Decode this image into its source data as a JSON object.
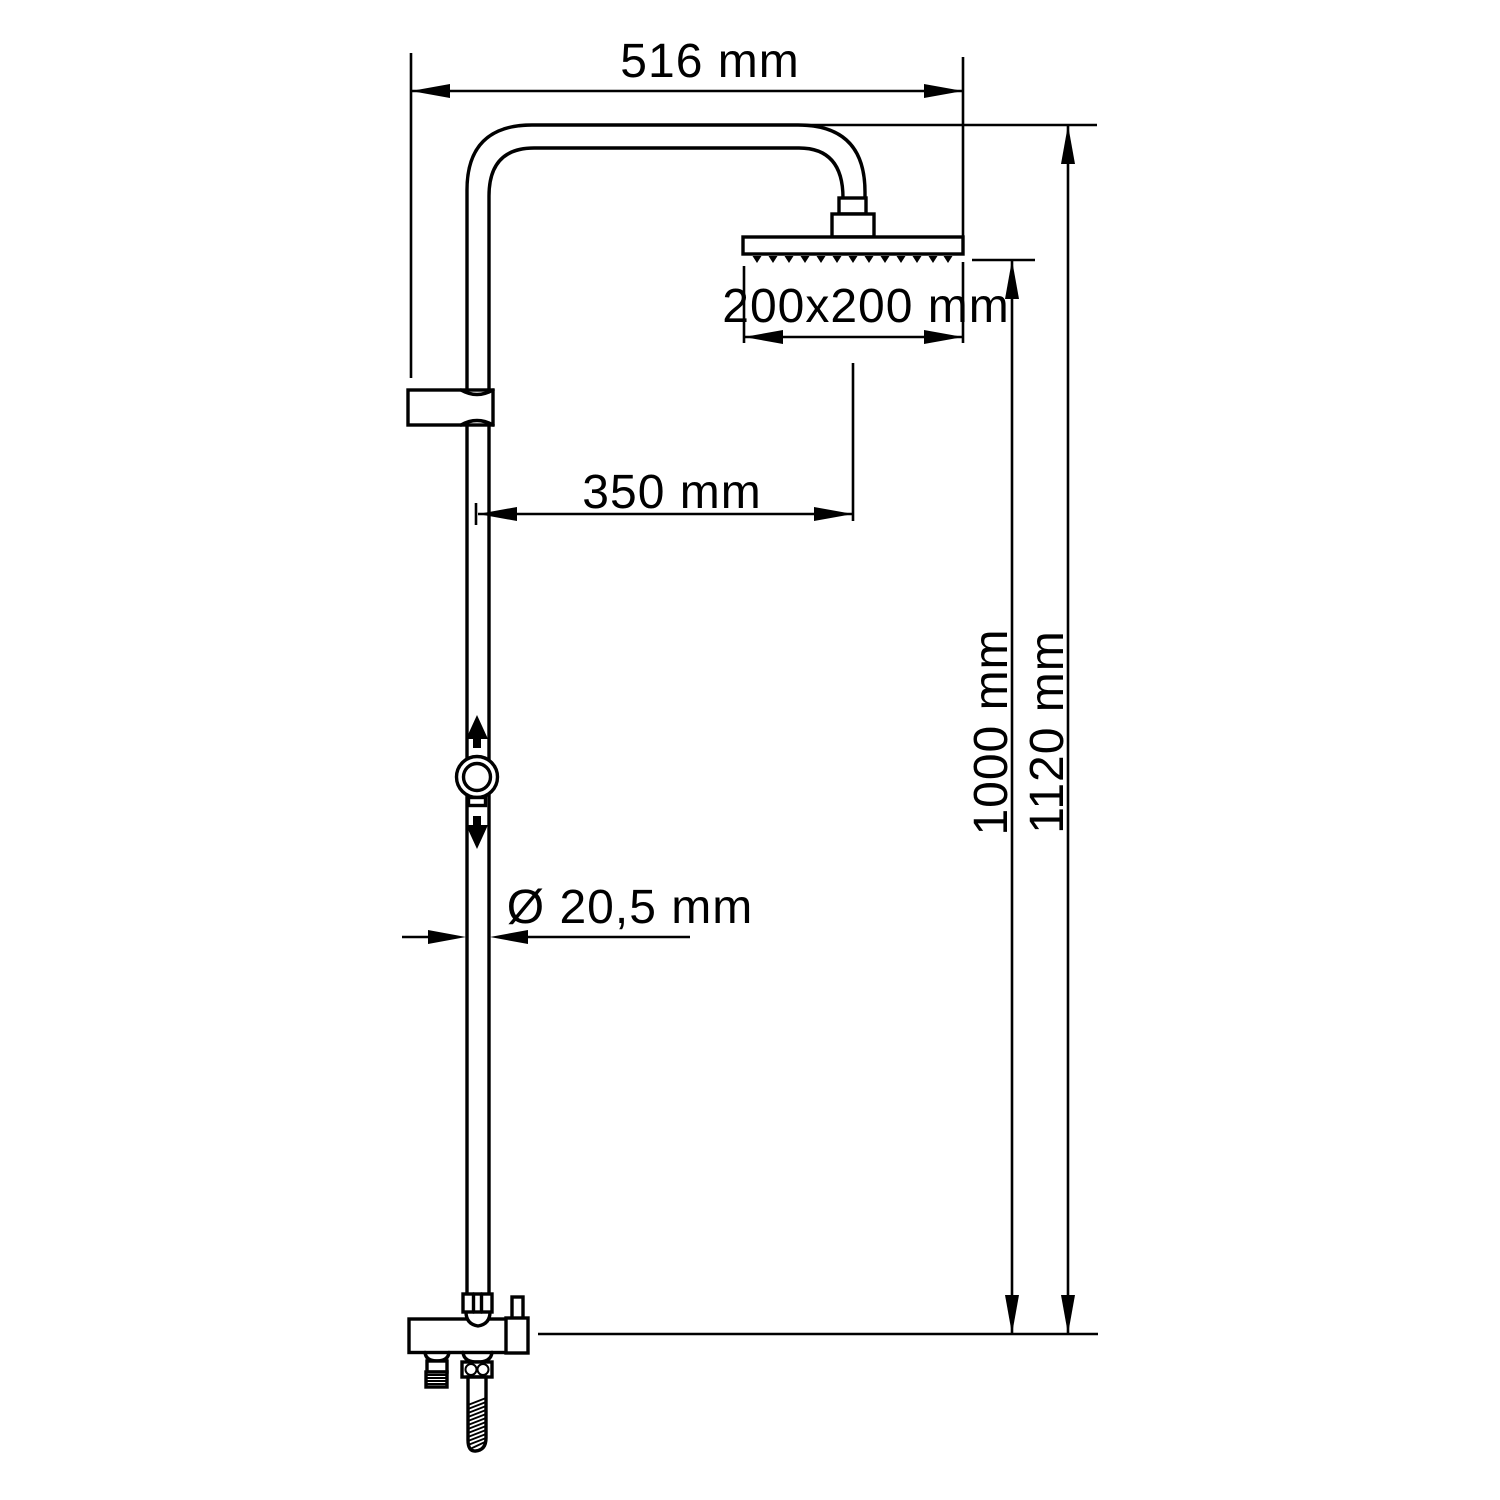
{
  "diagram": {
    "type": "technical-dimension-drawing",
    "subject": "shower column with overhead rain shower and hand shower outlet",
    "background_color": "#ffffff",
    "line_color": "#000000",
    "dimensions": {
      "arm_span": "516 mm",
      "head_size": "200x200 mm",
      "arm_reach": "350 mm",
      "pipe_diameter": "Ø 20,5 mm",
      "height_to_head": "1000 mm",
      "height_overall": "1120 mm"
    }
  }
}
